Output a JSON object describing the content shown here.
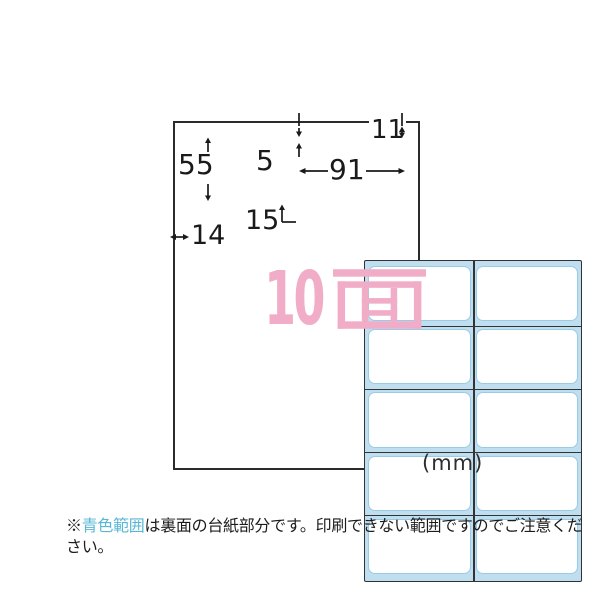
{
  "diagram": {
    "unit_label": "(mm)",
    "face_count": {
      "full_text": "10面",
      "number": "10",
      "unit_kanji": "面"
    },
    "dimensions": {
      "top_margin": "11",
      "label_height": "55",
      "top_inset": "5",
      "label_width": "91",
      "row_inset": "15",
      "left_margin": "14"
    },
    "grid": {
      "rows": 5,
      "columns": 2,
      "total_labels": 10
    }
  },
  "note": {
    "prefix": "※",
    "highlight": "青色範囲",
    "rest": "は裏面の台紙部分です。印刷できない範囲ですのでご注意ください。"
  },
  "colors": {
    "backing_blue": "#bfdff0",
    "count_pink": "#f1adc7",
    "note_highlight_blue": "#58b7d6",
    "cut_line": "#333333"
  }
}
